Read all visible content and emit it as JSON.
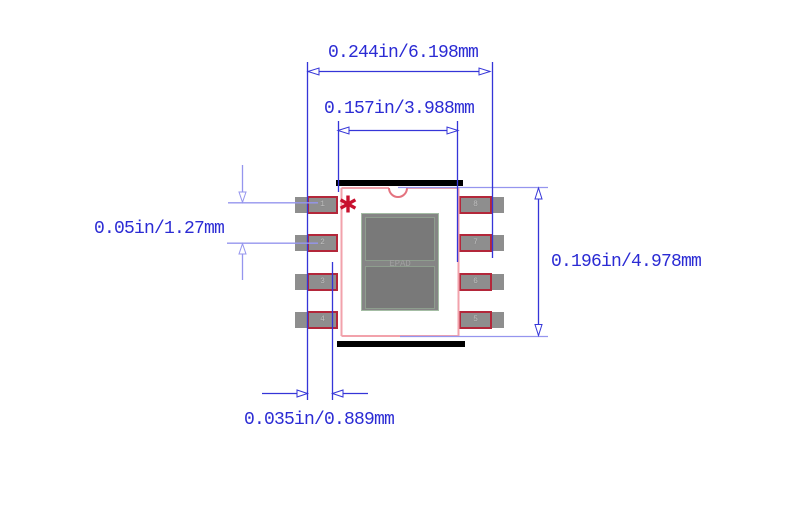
{
  "dimensions": {
    "overall_width": "0.244in/6.198mm",
    "body_width": "0.157in/3.988mm",
    "pin_pitch": "0.05in/1.27mm",
    "body_height": "0.196in/4.978mm",
    "pad_offset": "0.035in/0.889mm"
  },
  "package": {
    "epad_label": "EPAD",
    "left_pins": [
      "1",
      "2",
      "3",
      "4"
    ],
    "right_pins": [
      "8",
      "7",
      "6",
      "5"
    ]
  },
  "colors": {
    "dimension_blue": "#3535d8",
    "dimension_light_blue": "#9595ee",
    "label_blue": "#2b2bd4",
    "body_outline_pink": "#f2a2ab",
    "notch_red": "#e4737f",
    "pad_gray": "#8e8e8e",
    "pad_outline_red": "#b3273a",
    "pin1_marker_red": "#c8102e",
    "epad_border_green": "#a4bda4",
    "bar_black": "#000000"
  }
}
